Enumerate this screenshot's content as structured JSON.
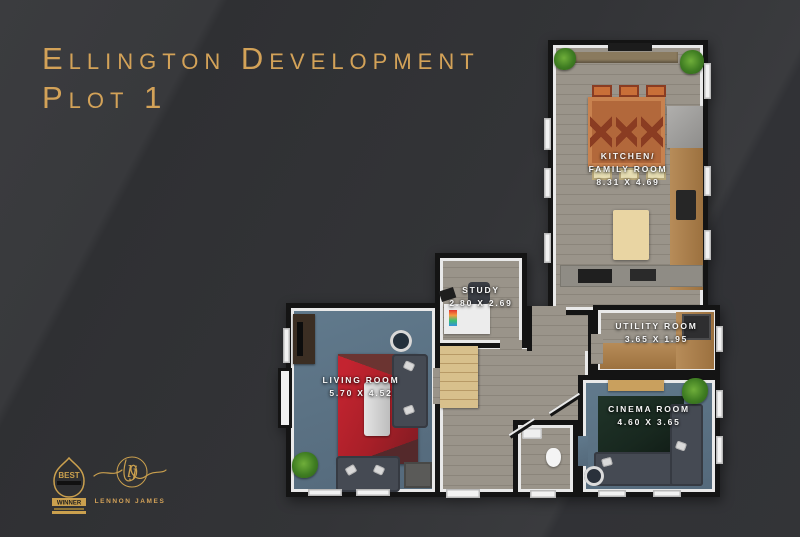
{
  "title": {
    "line1": "Ellington Development",
    "line2": "Plot 1"
  },
  "rooms": {
    "kitchen": {
      "name_line1": "Kitchen/",
      "name_line2": "Family Room",
      "dims": "8.31 x 4.69"
    },
    "study": {
      "name": "Study",
      "dims": "2.80 x 2.69"
    },
    "utility": {
      "name": "Utility Room",
      "dims": "3.65 x 1.95"
    },
    "living": {
      "name": "Living Room",
      "dims": "5.70 x 4.52"
    },
    "cinema": {
      "name": "Cinema Room",
      "dims": "4.60 x 3.65"
    }
  },
  "badges": {
    "award": {
      "top": "BEST",
      "banner": "WINNER"
    },
    "logo": {
      "monogram": "lj",
      "name": "Lennon James"
    }
  },
  "colors": {
    "bg": "#333437",
    "gold": "#d3a258",
    "wall": "#141414",
    "trim": "#e9e9e9",
    "wood": "#9a948a",
    "wood-dark": "#8b857b",
    "blue": "#5b7284",
    "rug-red": "#a81f28",
    "rug-green": "#18281f",
    "sofa": "#454a53",
    "counter-wood": "#a87f51",
    "island": "#e9d5a3",
    "table-orange": "#b2683b",
    "stairs": "#d8c08c"
  }
}
